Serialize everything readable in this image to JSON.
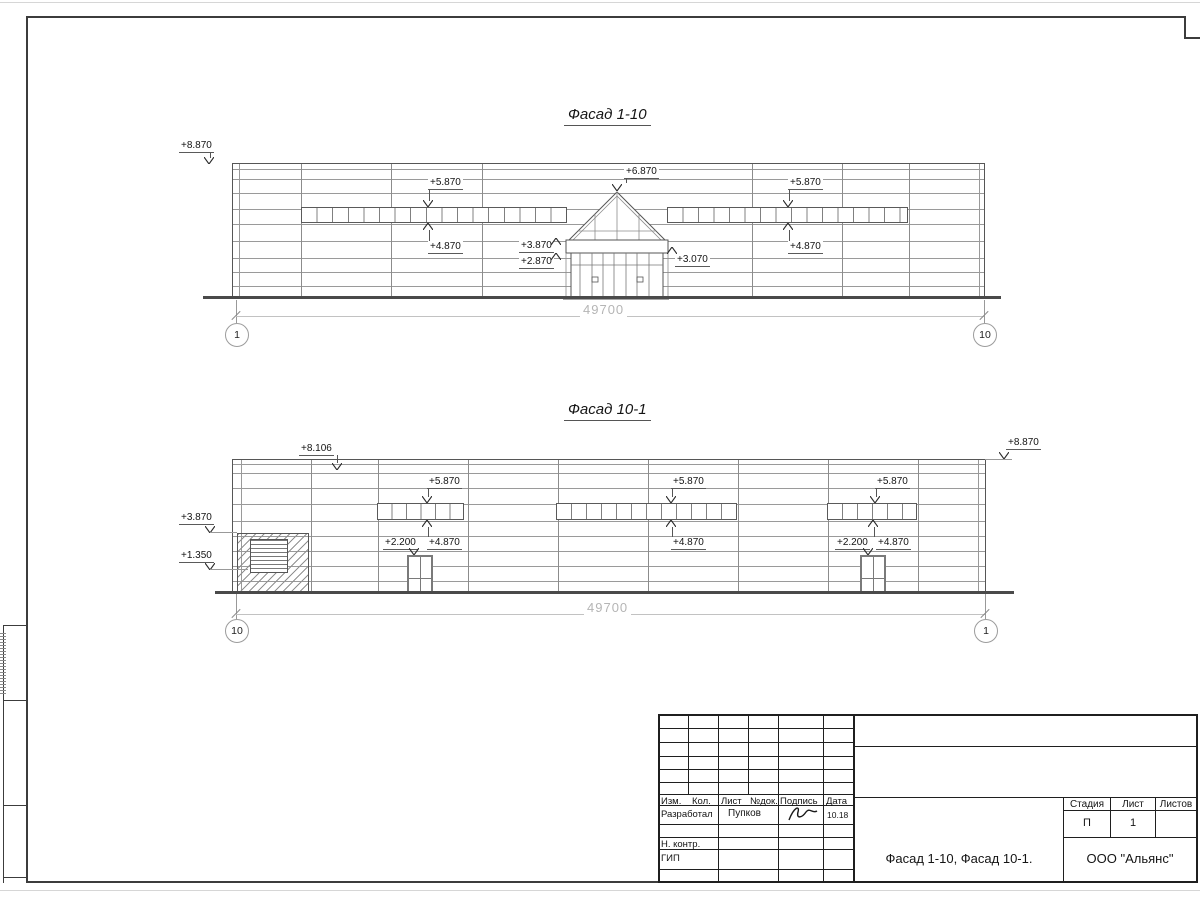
{
  "facade1": {
    "title": "Фасад 1-10",
    "dimension": "49700",
    "axis_left": "1",
    "axis_right": "10",
    "elev": {
      "top_left": "+8.870",
      "apex": "+6.870",
      "band_left_top": "+5.870",
      "band_left_bottom": "+4.870",
      "band_right_top": "+5.870",
      "band_right_bottom": "+4.870",
      "canopy_upper": "+3.870",
      "canopy_lower": "+2.870",
      "entry_right": "+3.070"
    }
  },
  "facade2": {
    "title": "Фасад 10-1",
    "dimension": "49700",
    "axis_left": "10",
    "axis_right": "1",
    "elev": {
      "roof": "+8.106",
      "top_right": "+8.870",
      "left_upper": "+3.870",
      "left_lower": "+1.350",
      "band1_top": "+5.870",
      "band1_bottom": "+4.870",
      "band2_top": "+5.870",
      "band2_bottom": "+4.870",
      "band3_top": "+5.870",
      "band3_bottom": "+4.870",
      "door1": "+2.200",
      "door2": "+2.200"
    }
  },
  "titleblock": {
    "col_izm": "Изм.",
    "col_kol": "Кол.",
    "col_list": "Лист",
    "col_ndok": "№док.",
    "col_podpis": "Подпись",
    "col_data": "Дата",
    "row_razrabotal": "Разработал",
    "razrabotal_name": "Пупков",
    "razrabotal_date": "10.18",
    "row_nkontr": "Н. контр.",
    "row_gip": "ГИП",
    "doc_title": "Фасад 1-10, Фасад 10-1.",
    "company": "ООО \"Альянс\"",
    "stadiya_label": "Стадия",
    "list_label": "Лист",
    "listov_label": "Листов",
    "stadiya_value": "П",
    "list_value": "1",
    "listov_value": ""
  }
}
